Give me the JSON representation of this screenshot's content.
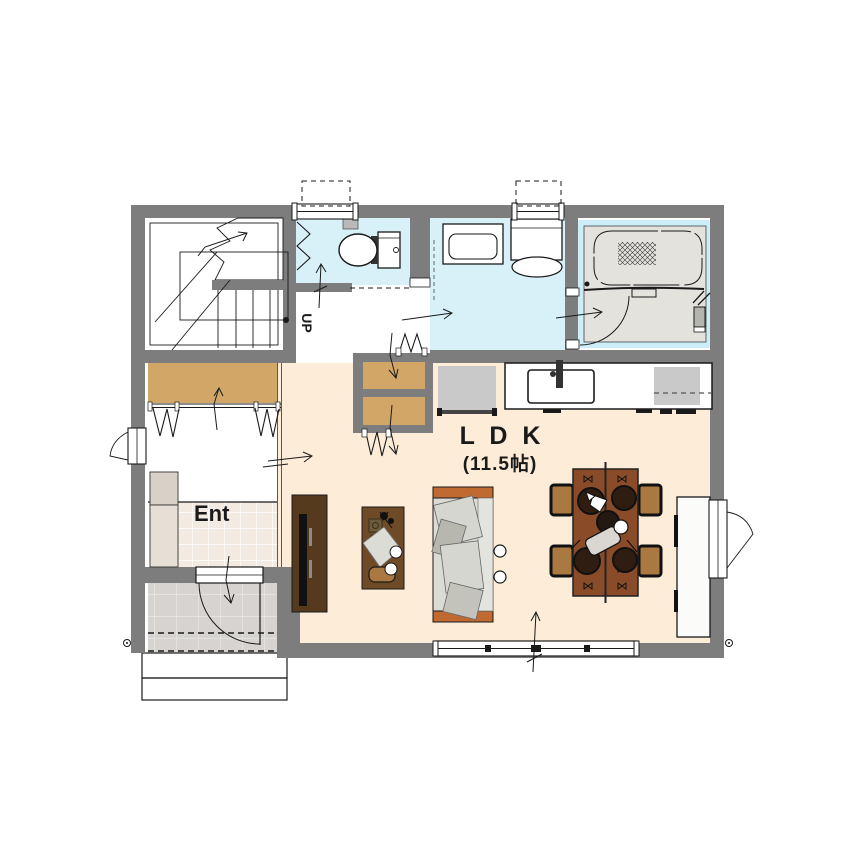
{
  "labels": {
    "ldk": "L D K",
    "ldk_size": "(11.5帖)",
    "entrance": "Ent",
    "stairs_up": "UP"
  },
  "colors": {
    "wall": "#7d7d7d",
    "line": "#1a1a1a",
    "ldk_floor": "#fcecd8",
    "hall_floor": "#ffffff",
    "wet_floor": "#d8f1f9",
    "bath_border": "#cdeef6",
    "bath_floor": "#e3e2dd",
    "closet_wood": "#d2a667",
    "genkan_tile": "#f3ebe2",
    "porch_tile": "#d6d3d0",
    "cabinet_light": "#e6dfd6",
    "cabinet_dark": "#d8d1c8",
    "wood_dark": "#563a1d",
    "desk_wood": "#6f4a26",
    "dining_wood": "#8a4c28",
    "chair_wood": "#aa7841",
    "sofa_body": "#dbdbd6",
    "sofa_arm": "#c06a31",
    "appliance_gray": "#c9c9c9"
  }
}
